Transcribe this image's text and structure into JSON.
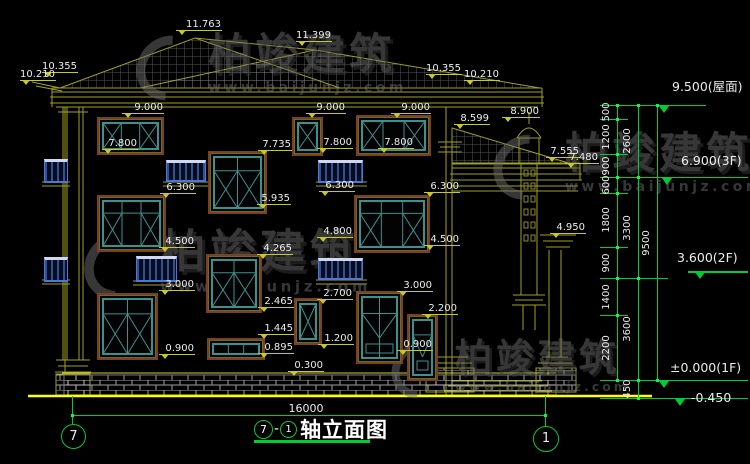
{
  "drawing": {
    "title": "轴立面图",
    "axis_from": "7",
    "axis_to": "1",
    "separator": "-",
    "total_width_dim": "16000"
  },
  "watermark": {
    "brand": "柏竣建筑",
    "url": "www.baijunjz.com"
  },
  "colors": {
    "background": "#000000",
    "cad_line_yellow": "#a0a020",
    "ground_yellow": "#ffff00",
    "dimension_green": "#00cc33",
    "text_white": "#ececec",
    "window_frame_teal": "#3f8f8f",
    "window_trim_maroon": "#7b3f22",
    "railing_blue": "#4a78d8",
    "watermark_gray": "#6e6e6e"
  },
  "elevation_markers": [
    {
      "v": "11.763",
      "x": 176,
      "y": 30,
      "w": 46
    },
    {
      "v": "10.355",
      "x": 42,
      "y": 72,
      "w": 36
    },
    {
      "v": "10.210",
      "x": 20,
      "y": 80,
      "w": 36
    },
    {
      "v": "11.399",
      "x": 296,
      "y": 41,
      "w": 36
    },
    {
      "v": "10.355",
      "x": 426,
      "y": 74,
      "w": 36
    },
    {
      "v": "10.210",
      "x": 464,
      "y": 80,
      "w": 36
    },
    {
      "v": "9.000",
      "x": 122,
      "y": 113,
      "w": 42
    },
    {
      "v": "9.000",
      "x": 306,
      "y": 113,
      "w": 40
    },
    {
      "v": "9.000",
      "x": 391,
      "y": 113,
      "w": 40
    },
    {
      "v": "8.900",
      "x": 502,
      "y": 117,
      "w": 38
    },
    {
      "v": "8.599",
      "x": 454,
      "y": 124,
      "w": 36
    },
    {
      "v": "7.800",
      "x": 102,
      "y": 149,
      "w": 36
    },
    {
      "v": "7.800",
      "x": 317,
      "y": 148,
      "w": 36
    },
    {
      "v": "7.800",
      "x": 378,
      "y": 148,
      "w": 36
    },
    {
      "v": "7.735",
      "x": 258,
      "y": 150,
      "w": 34
    },
    {
      "v": "7.555",
      "x": 546,
      "y": 157,
      "w": 34
    },
    {
      "v": "7.480",
      "x": 565,
      "y": 163,
      "w": 34
    },
    {
      "v": "6.300",
      "x": 160,
      "y": 193,
      "w": 36
    },
    {
      "v": "6.300",
      "x": 319,
      "y": 191,
      "w": 36
    },
    {
      "v": "6.300",
      "x": 424,
      "y": 192,
      "w": 36
    },
    {
      "v": "5.935",
      "x": 257,
      "y": 204,
      "w": 34
    },
    {
      "v": "4.950",
      "x": 550,
      "y": 233,
      "w": 36
    },
    {
      "v": "4.800",
      "x": 317,
      "y": 237,
      "w": 36
    },
    {
      "v": "4.500",
      "x": 159,
      "y": 247,
      "w": 36
    },
    {
      "v": "4.500",
      "x": 424,
      "y": 245,
      "w": 36
    },
    {
      "v": "4.265",
      "x": 257,
      "y": 254,
      "w": 36
    },
    {
      "v": "3.000",
      "x": 159,
      "y": 290,
      "w": 36
    },
    {
      "v": "3.000",
      "x": 397,
      "y": 291,
      "w": 36
    },
    {
      "v": "2.700",
      "x": 317,
      "y": 299,
      "w": 36
    },
    {
      "v": "2.465",
      "x": 258,
      "y": 307,
      "w": 36
    },
    {
      "v": "2.200",
      "x": 422,
      "y": 314,
      "w": 36
    },
    {
      "v": "1.445",
      "x": 258,
      "y": 334,
      "w": 36
    },
    {
      "v": "1.200",
      "x": 318,
      "y": 344,
      "w": 36
    },
    {
      "v": "0.900",
      "x": 159,
      "y": 354,
      "w": 36
    },
    {
      "v": "0.900",
      "x": 397,
      "y": 350,
      "w": 36
    },
    {
      "v": "0.895",
      "x": 258,
      "y": 353,
      "w": 36
    },
    {
      "v": "0.300",
      "x": 288,
      "y": 371,
      "w": 36
    }
  ],
  "right_dimension_chains": {
    "chain1": [
      {
        "v": "500",
        "y1": 105,
        "y2": 119
      },
      {
        "v": "1200",
        "y1": 119,
        "y2": 154
      },
      {
        "v": "900",
        "y1": 154,
        "y2": 177
      },
      {
        "v": "600",
        "y1": 177,
        "y2": 193
      },
      {
        "v": "1800",
        "y1": 193,
        "y2": 247
      },
      {
        "v": "900",
        "y1": 247,
        "y2": 278
      },
      {
        "v": "1400",
        "y1": 278,
        "y2": 315
      },
      {
        "v": "2200",
        "y1": 315,
        "y2": 380
      }
    ],
    "chain2": [
      {
        "v": "2600",
        "y1": 105,
        "y2": 177
      },
      {
        "v": "3300",
        "y1": 177,
        "y2": 278
      },
      {
        "v": "3600",
        "y1": 278,
        "y2": 380
      },
      {
        "v": "450",
        "y1": 380,
        "y2": 398
      }
    ],
    "chain3": [
      {
        "v": "9500",
        "y1": 105,
        "y2": 380
      }
    ]
  },
  "level_labels": [
    {
      "v": "9.500(屋面)",
      "tx": 672,
      "ty": 76,
      "trx": 659,
      "try": 106
    },
    {
      "v": "6.900(3F)",
      "tx": 681,
      "ty": 153,
      "trx": 662,
      "try": 178
    },
    {
      "v": "3.600(2F)",
      "tx": 677,
      "ty": 250,
      "trx": 695,
      "try": 272,
      "line": {
        "x": 688,
        "y": 271,
        "w": 60
      }
    },
    {
      "v": "±0.000(1F)",
      "tx": 670,
      "ty": 360,
      "trx": 659,
      "try": 381
    },
    {
      "v": "-0.450",
      "tx": 691,
      "ty": 390,
      "trx": 675,
      "try": 399
    }
  ],
  "windows": [
    {
      "x": 97,
      "y": 117,
      "w": 67,
      "h": 38,
      "cols": 3,
      "type": "win"
    },
    {
      "x": 292,
      "y": 117,
      "w": 31,
      "h": 39,
      "cols": 1,
      "type": "win"
    },
    {
      "x": 356,
      "y": 115,
      "w": 75,
      "h": 41,
      "cols": 3,
      "type": "win"
    },
    {
      "x": 208,
      "y": 151,
      "w": 59,
      "h": 63,
      "cols": 2,
      "type": "win2"
    },
    {
      "x": 97,
      "y": 195,
      "w": 69,
      "h": 57,
      "cols": 3,
      "type": "win2"
    },
    {
      "x": 354,
      "y": 195,
      "w": 76,
      "h": 58,
      "cols": 3,
      "type": "win2"
    },
    {
      "x": 206,
      "y": 254,
      "w": 56,
      "h": 59,
      "cols": 2,
      "type": "win2"
    },
    {
      "x": 97,
      "y": 293,
      "w": 61,
      "h": 67,
      "cols": 2,
      "type": "win2"
    },
    {
      "x": 294,
      "y": 298,
      "w": 28,
      "h": 47,
      "cols": 1,
      "type": "win"
    },
    {
      "x": 356,
      "y": 291,
      "w": 47,
      "h": 73,
      "cols": 2,
      "type": "door"
    },
    {
      "x": 407,
      "y": 314,
      "w": 31,
      "h": 67,
      "cols": 1,
      "type": "door"
    },
    {
      "x": 207,
      "y": 338,
      "w": 58,
      "h": 22,
      "cols": 3,
      "type": "strip"
    }
  ],
  "railings": [
    {
      "x": 44,
      "y": 159,
      "w": 24,
      "h": 24
    },
    {
      "x": 44,
      "y": 257,
      "w": 24,
      "h": 25
    },
    {
      "x": 166,
      "y": 160,
      "w": 40,
      "h": 22
    },
    {
      "x": 318,
      "y": 160,
      "w": 45,
      "h": 23
    },
    {
      "x": 136,
      "y": 256,
      "w": 41,
      "h": 26
    },
    {
      "x": 318,
      "y": 258,
      "w": 45,
      "h": 22
    }
  ]
}
